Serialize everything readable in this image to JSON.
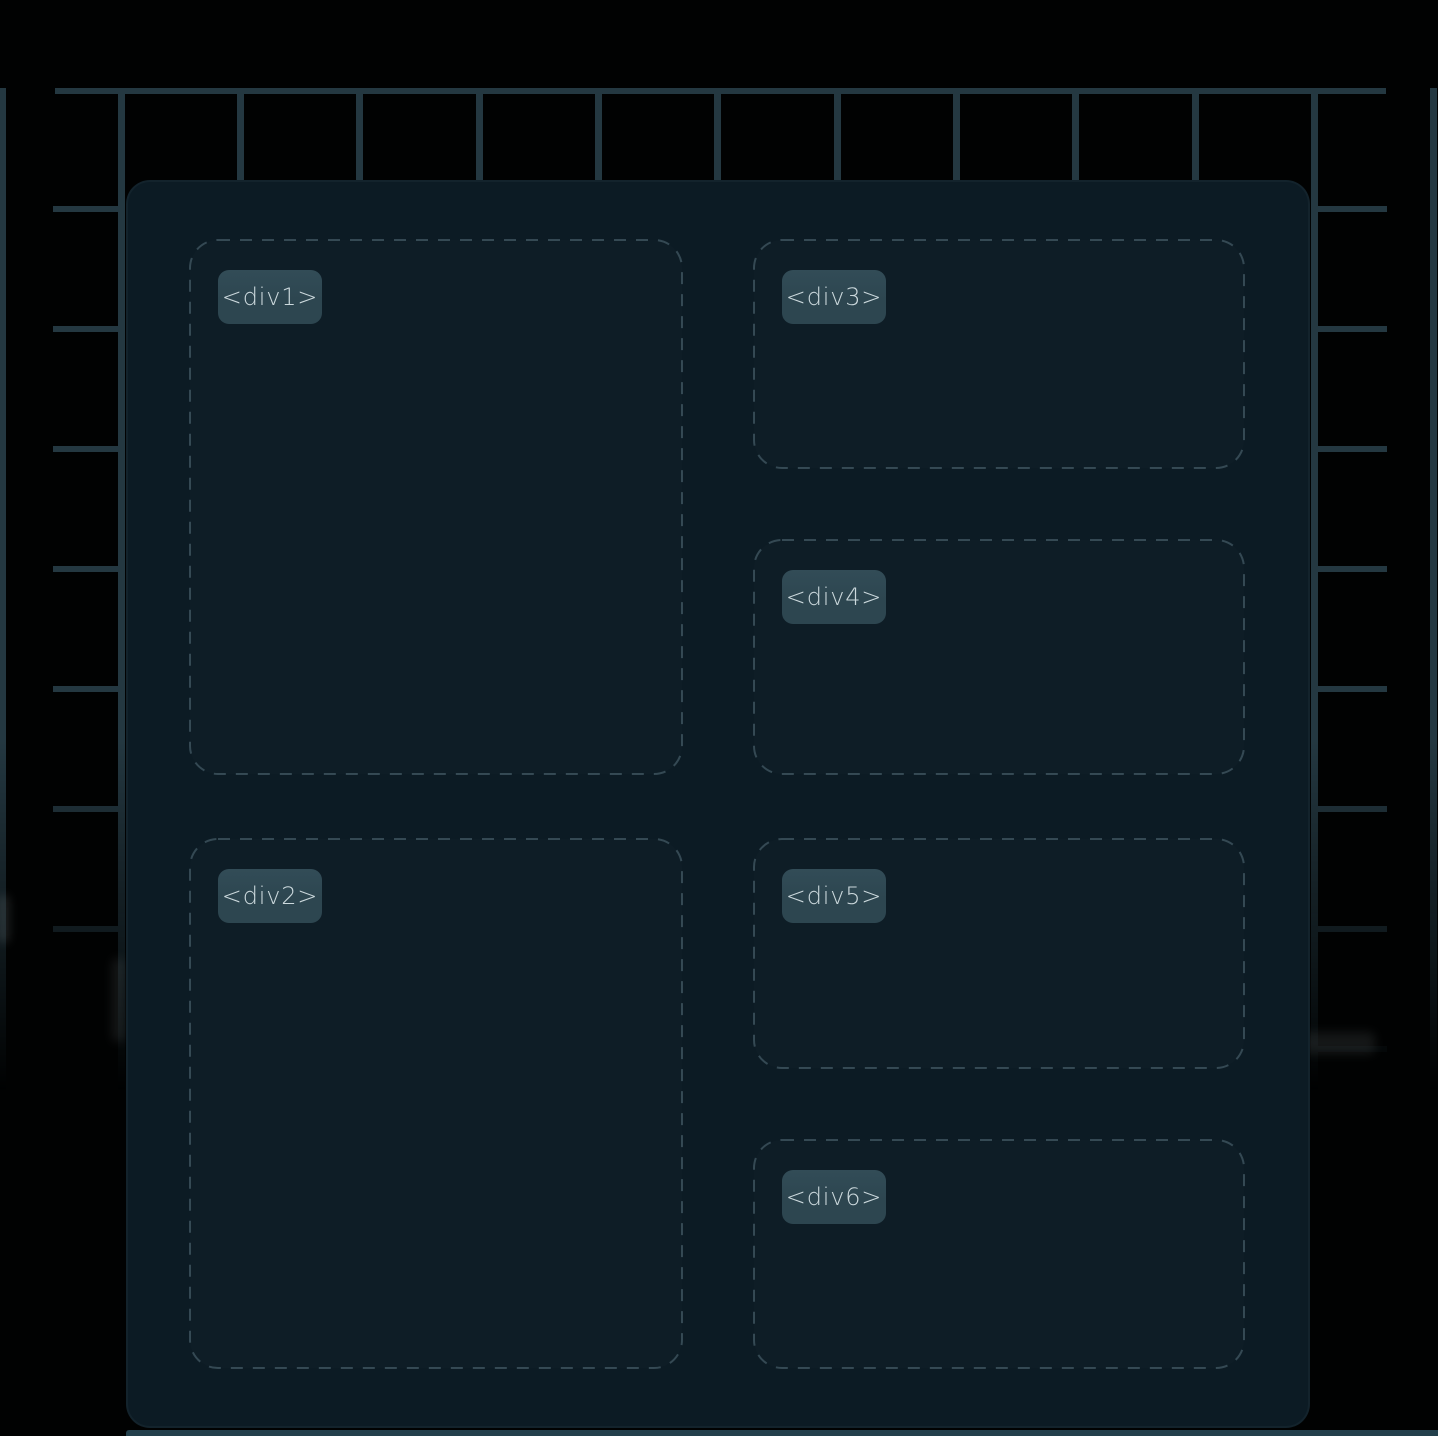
{
  "colors": {
    "page_bg": "#010202",
    "grid_line": "#243841",
    "panel_bg": "#0c1b24",
    "panel_bottom_strip": "#23404c",
    "box_border": "rgba(145,180,192,0.30)",
    "chip_bg": "#2d4650",
    "chip_text": "#ccd9dd"
  },
  "boxes": [
    {
      "name": "div1",
      "label": "<div1>"
    },
    {
      "name": "div2",
      "label": "<div2>"
    },
    {
      "name": "div3",
      "label": "<div3>"
    },
    {
      "name": "div4",
      "label": "<div4>"
    },
    {
      "name": "div5",
      "label": "<div5>"
    },
    {
      "name": "div6",
      "label": "<div6>"
    }
  ]
}
